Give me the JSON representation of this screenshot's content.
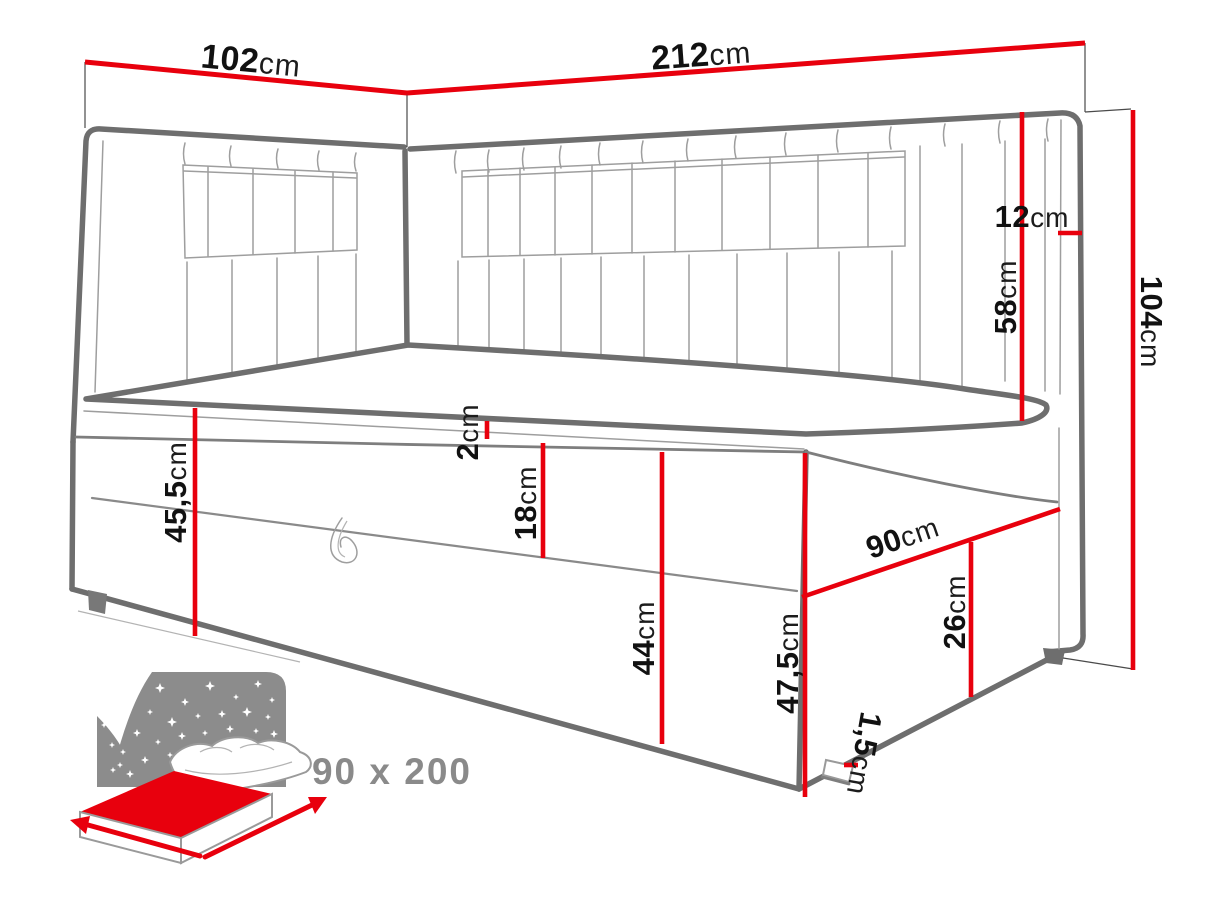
{
  "diagram": {
    "type": "furniture-dimension-drawing",
    "subject": "corner bed with upholstered headboard panels",
    "unit": "cm",
    "colors": {
      "accent": "#e8000d",
      "outline": "#6e6e6e",
      "icon_gray": "#8c8c8c",
      "label": "#111111"
    }
  },
  "dims": {
    "d102": {
      "num": "102",
      "unit": "cm",
      "value": 102,
      "meaning": "side headboard width"
    },
    "d212": {
      "num": "212",
      "unit": "cm",
      "value": 212,
      "meaning": "back headboard length"
    },
    "d12": {
      "num": "12",
      "unit": "cm",
      "value": 12,
      "meaning": "headboard rail thickness"
    },
    "d58": {
      "num": "58",
      "unit": "cm",
      "value": 58,
      "meaning": "headboard height above mattress"
    },
    "d104": {
      "num": "104",
      "unit": "cm",
      "value": 104,
      "meaning": "total height"
    },
    "d455": {
      "num": "45,5",
      "unit": "cm",
      "value": 45.5,
      "meaning": "mattress top to floor at head end"
    },
    "d2": {
      "num": "2",
      "unit": "cm",
      "value": 2,
      "meaning": "mattress topper thickness"
    },
    "d18": {
      "num": "18",
      "unit": "cm",
      "value": 18,
      "meaning": "mattress height"
    },
    "d44": {
      "num": "44",
      "unit": "cm",
      "value": 44,
      "meaning": "base box height"
    },
    "d90": {
      "num": "90",
      "unit": "cm",
      "value": 90,
      "meaning": "bed width at foot end"
    },
    "d26": {
      "num": "26",
      "unit": "cm",
      "value": 26,
      "meaning": "side panel height"
    },
    "d475": {
      "num": "47,5",
      "unit": "cm",
      "value": 47.5,
      "meaning": "front corner height"
    },
    "d15": {
      "num": "1,5",
      "unit": "cm",
      "value": 1.5,
      "meaning": "foot / glide height"
    }
  },
  "icon": {
    "size_label": "90 x 200",
    "mattress_size": "90 x 200"
  }
}
